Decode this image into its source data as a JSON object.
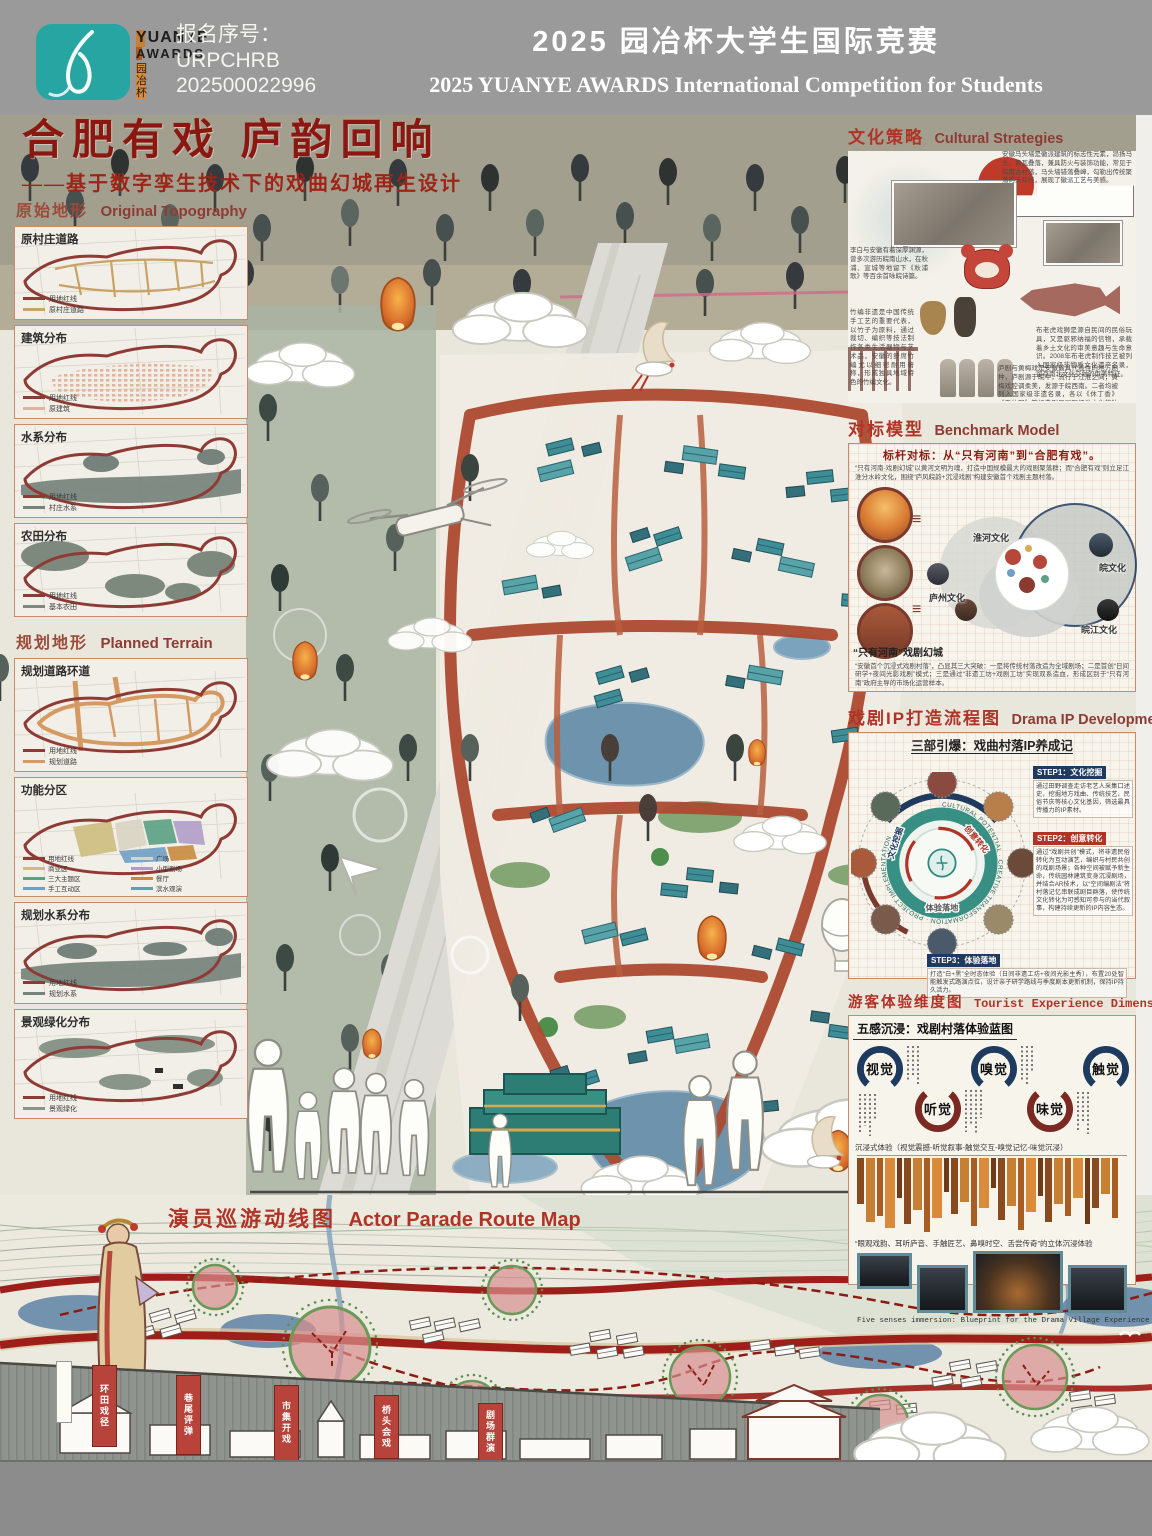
{
  "header": {
    "brand": {
      "line1": "YUANYE",
      "line2": "AWARDS",
      "cn": "园 冶 杯"
    },
    "reg_label": "报名序号：",
    "reg_code": "URPCHRB",
    "reg_number": "202500022996",
    "title_cn": "2025 园冶杯大学生国际竞赛",
    "title_en": "2025 YUANYE AWARDS International Competition for  Students"
  },
  "poster": {
    "title_cn": "合肥有戏 庐韵回响",
    "subtitle": "——基于数字孪生技术下的戏曲幻城再生设计"
  },
  "sidebar": {
    "original": {
      "title_cn": "原始地形",
      "title_en": "Original Topography",
      "maps": [
        {
          "label": "原村庄道路",
          "legend": [
            {
              "name": "用地红线"
            },
            {
              "name": "原村庄道路"
            }
          ]
        },
        {
          "label": "建筑分布",
          "legend": [
            {
              "name": "用地红线"
            },
            {
              "name": "原建筑"
            }
          ]
        },
        {
          "label": "水系分布",
          "legend": [
            {
              "name": "用地红线"
            },
            {
              "name": "村庄水系"
            }
          ]
        },
        {
          "label": "农田分布",
          "legend": [
            {
              "name": "用地红线"
            },
            {
              "name": "基本农田"
            }
          ]
        }
      ]
    },
    "planned": {
      "title_cn": "规划地形",
      "title_en": "Planned Terrain",
      "maps": [
        {
          "label": "规划道路环道",
          "legend": [
            {
              "name": "用地红线"
            },
            {
              "name": "规划道路"
            }
          ]
        },
        {
          "label": "功能分区",
          "legend": [
            {
              "name": "用地红线"
            },
            {
              "name": "广场"
            },
            {
              "name": "商业区"
            },
            {
              "name": "小型剧场"
            },
            {
              "name": "三大主题区"
            },
            {
              "name": "餐厅"
            },
            {
              "name": "手工互动区"
            },
            {
              "name": "滨水观演"
            }
          ]
        },
        {
          "label": "规划水系分布",
          "legend": [
            {
              "name": "用地红线"
            },
            {
              "name": "规划水系"
            }
          ]
        },
        {
          "label": "景观绿化分布",
          "legend": [
            {
              "name": "用地红线"
            },
            {
              "name": "景观绿化"
            }
          ]
        }
      ]
    }
  },
  "right": {
    "cultural": {
      "title_cn": "文化策略",
      "title_en": "Cultural Strategies",
      "notes": [
        "安徽马头墙是徽派建筑的标志性元素，昂扬马头、青瓦叠落，兼具防火与装饰功能，常见于皖南古村落，马头墙错落叠嶂，勾勒出传统聚落的天际线，展现了徽派工艺与美感。",
        "李白与安徽有着深厚渊源，曾多次游历皖南山水，在秋浦、宣城等地留下《秋浦歌》等百余首咏皖诗篇。",
        "竹编非遗是中国传统手工艺的重要代表，以竹子为原料，通过裁切、编织等技法制作各类生活器物与艺术品，安徽的舒席竹编尤以细密耐用著称，形成独具地域特色的竹编文化。",
        "布老虎戏狮是源自民间的民俗玩具，又是驱邪纳福的信物，承载着乡土文化的审美意趣与生命意识。2008年布老虎制作技艺被列入国家级非物质文化遗产名录，留存南北文化交融的审美特征。",
        "庐剧与黄梅戏是安徽最具代表性的地方剧种，庐剧源于皖中，流行于江淮之间；黄梅戏腔调柔美，发源于皖西南。二者均被列入国家级非遗名录，各以《休丁香》《天仙配》等经典剧目展现江淮文化的独特魅力。"
      ]
    },
    "benchmark": {
      "title_cn": "对标模型",
      "title_en": "Benchmark Model",
      "headline": "标杆对标：从“只有河南”到“合肥有戏”。",
      "left_caption": "“只有河南”戏剧幻城",
      "bubbles": [
        "淮河文化",
        "皖文化",
        "庐州文化",
        "皖江文化"
      ],
      "para_top": "“只有河南·戏剧幻城”以黄河文明为魂，打造中国规模最大的戏剧聚落群；而“合肥有戏”则立足江淮分水岭文化，围绕“庐风皖韵+沉浸戏剧”构建安徽首个戏剧主题村落。",
      "para_bottom": "“安徽首个沉浸式戏剧村落”，凸显其三大突破：一是将传统村落改造为全域剧场；二是首创“日间研学+夜间光影戏剧”模式；三是通过“非遗工坊+戏剧工坊”实现双系造血，形成区别于“只有河南”政府主导的市场化运营样本。"
    },
    "ip": {
      "title_cn": "戏剧IP打造流程图",
      "title_en": "Drama IP Development",
      "subtitle": "三部引爆：戏曲村落IP养成记",
      "ring_en": "CULTURAL POTENTIAL · CREATIVE TRANSFORMATION · PROJECT IMPLEMENTATION",
      "ring_labels": [
        "文化挖掘",
        "创意转化",
        "体验落地"
      ],
      "steps": [
        {
          "tag": "STEP1：文化挖掘",
          "text": "通过田野调查走访老艺人采集口述史，挖掘地方戏曲、传统技艺、民俗节庆等核心文化基因，筛选最具传播力的IP素材。"
        },
        {
          "tag": "STEP2：创意转化",
          "text": "通过“戏剧共创”模式，将非遗民俗转化为互动演艺，编织与村民共创的戏剧场景；各种空间被赋予新生命，传统园林建筑变身沉浸剧场，并结合AR技术，以“空间编剧法”将村落记忆串联成剧目群落，使传统文化转化为可感知可参与的当代叙事，构建持续更新的IP内容生态。"
        },
        {
          "tag": "STEP3：体验落地",
          "text": "打造“白+黑”全时态体验（日间非遗工坊+夜间光影主秀），布置20处智能触发式路演点位，设计亲子研学路线与季度剧本更新机制，保持IP持久活力。"
        }
      ]
    },
    "experience": {
      "title_cn": "游客体验维度图",
      "title_en": "Tourist Experience Dimensions Map",
      "subtitle": "五感沉浸：戏剧村落体验蓝图",
      "senses": [
        {
          "label": "视觉"
        },
        {
          "label": "听觉"
        },
        {
          "label": "嗅觉"
        },
        {
          "label": "味觉"
        },
        {
          "label": "触觉"
        }
      ],
      "bar_caption": "沉浸式体验（视觉震撼-听觉叙事-触觉交互-嗅觉记忆-味觉沉浸）",
      "bars": [
        46,
        64,
        58,
        70,
        40,
        66,
        52,
        74,
        60,
        34,
        56,
        44,
        68,
        50,
        30,
        62,
        48,
        72,
        54,
        38,
        64,
        46,
        58,
        40,
        66,
        50,
        36,
        60
      ],
      "line": "“眼观戏韵、耳听庐音、手触匠艺、鼻嗅时空、舌尝传奇”的立体沉浸体验",
      "photo_caption": "Five senses immersion: Blueprint for the Drama Village Experience"
    }
  },
  "parade": {
    "title_cn": "演员巡游动线图",
    "title_en": "Actor Parade Route Map",
    "banners": [
      "环田戏径",
      "巷尾评弹",
      "市集开戏",
      "桥头会戏",
      "剧场群演"
    ]
  },
  "colors": {
    "accent_red": "#8e1b12",
    "title_red": "#b03326",
    "boundary_red": "#8e3b35",
    "teal_roof": "#3f8d96",
    "brand_teal": "#27a5a2",
    "road_red": "#ad4a31",
    "navy": "#1f3a5f",
    "node_green": "#5b8f4e",
    "node_pink": "#d98f8f",
    "lantern_orange": "#d96f2e",
    "header_gray": "#9a9a9a",
    "footer_gray": "#8c8c8c"
  }
}
